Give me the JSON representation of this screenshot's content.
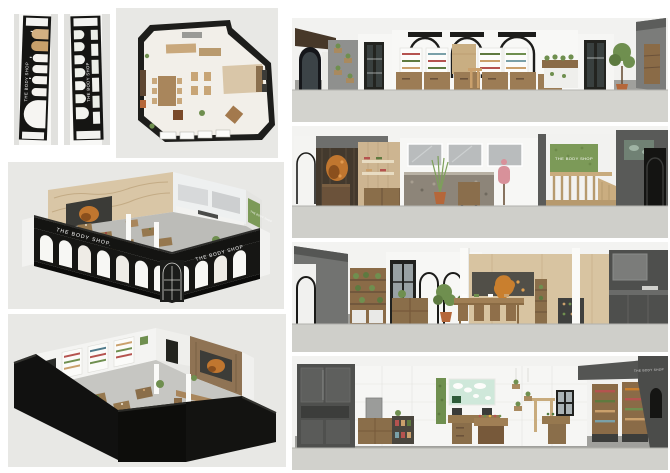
{
  "brand": {
    "name": "THE BODY SHOP",
    "name_with_period": "THE BODY SHOP."
  },
  "colors": {
    "page_background": "#ffffff",
    "panel_background": "#e8e8e5",
    "ground_gray": "#d2d2cd",
    "facade_black": "#141412",
    "interior_floor": "#a0a09c",
    "wood_medium": "#9a7c55",
    "wood_dark": "#6b523a",
    "beige_wall": "#d8c4a1",
    "plan_floor": "#f2efe9",
    "plant_green": "#6f8f4f",
    "plant_wall_green": "#7c9a58",
    "accent_orange": "#c0762f",
    "map_mint": "#cfe8da",
    "wall_gray": "#6e6f6d",
    "dark_cabinet_gray": "#4f504e",
    "mirror_gray": "#b9bcbd",
    "terracotta": "#b5673a"
  }
}
